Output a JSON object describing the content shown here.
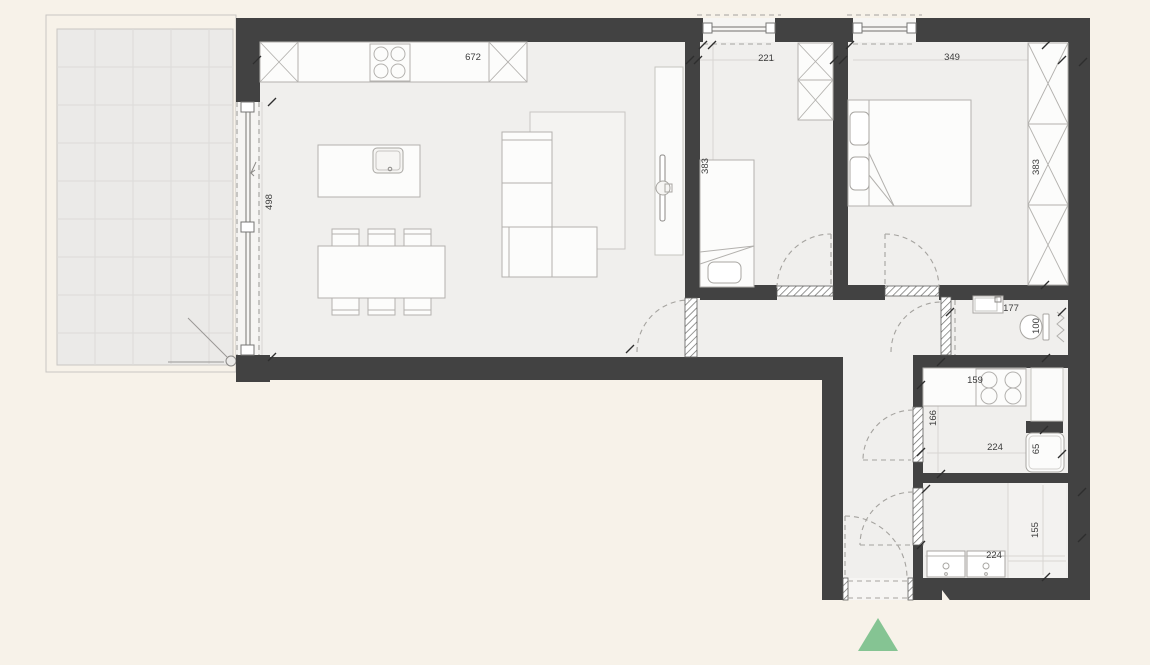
{
  "plan": {
    "type": "apartment-floor-plan",
    "colors": {
      "background": "#f7f2e9",
      "floor": "#f0efed",
      "terrace_tile": "#ebeae8",
      "wall": "#424242",
      "furniture_line": "#b3b1ae",
      "dashed_line": "#a5a39f",
      "entrance_marker": "#85c493",
      "label_text": "#3c3c3c"
    },
    "dimension_labels": [
      {
        "text": "672",
        "area": "living-room-top"
      },
      {
        "text": "221",
        "area": "bedroom-1-window"
      },
      {
        "text": "349",
        "area": "bedroom-2-window"
      },
      {
        "text": "498",
        "area": "terrace-sliding-door"
      },
      {
        "text": "383",
        "area": "bedroom-1-depth"
      },
      {
        "text": "383",
        "area": "bedroom-2-depth"
      },
      {
        "text": "177",
        "area": "bathroom-1-width"
      },
      {
        "text": "100",
        "area": "bathroom-1-depth"
      },
      {
        "text": "159",
        "area": "kitchen-counter"
      },
      {
        "text": "166",
        "area": "kitchen-depth"
      },
      {
        "text": "224",
        "area": "kitchen-width"
      },
      {
        "text": "65",
        "area": "kitchen-appliance"
      },
      {
        "text": "224",
        "area": "bathroom-2-width"
      },
      {
        "text": "155",
        "area": "bathroom-2-depth"
      }
    ],
    "entrance_marker": "green-triangle"
  }
}
